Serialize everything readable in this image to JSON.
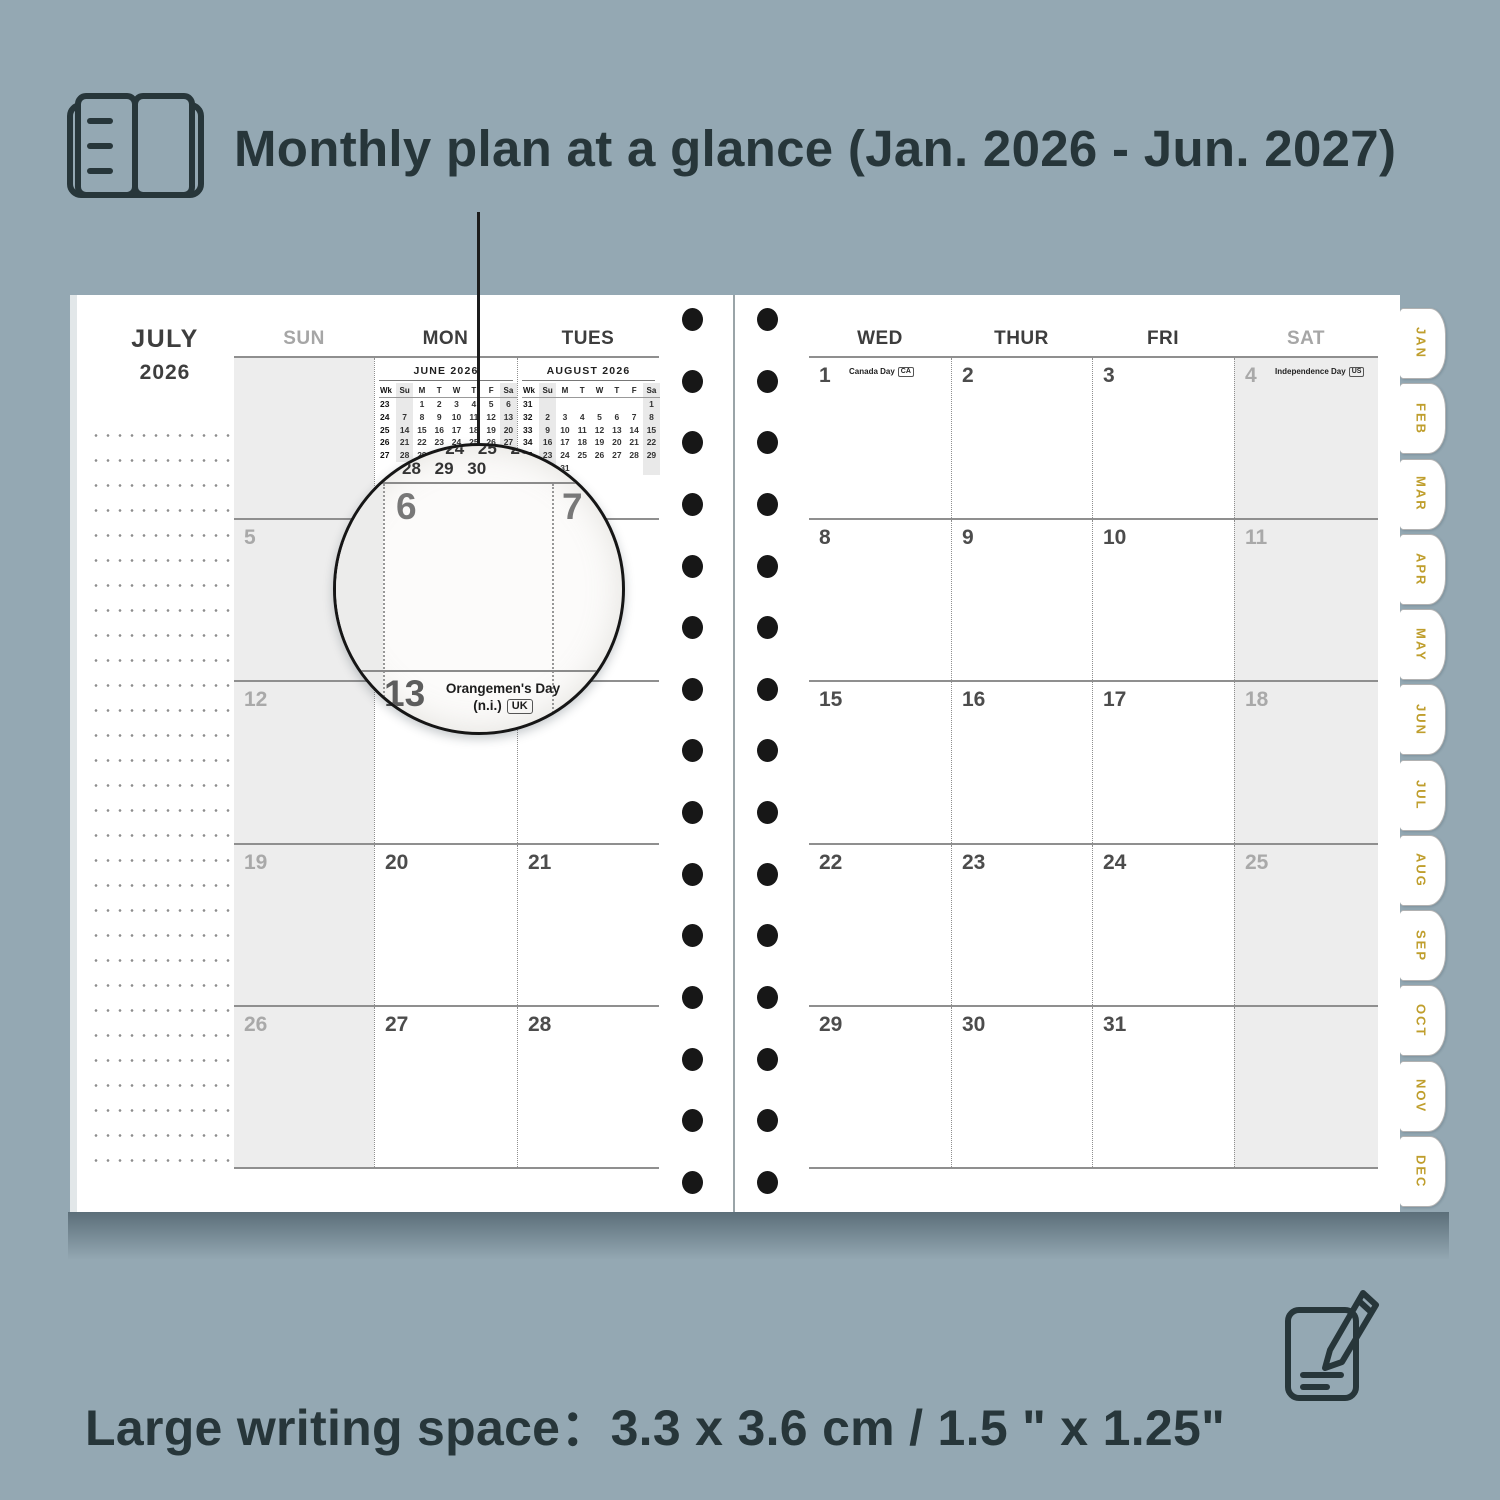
{
  "background_color": "#94a8b3",
  "accent_gold": "#bf9e2c",
  "top_caption": {
    "icon": "open-planner-icon",
    "text": "Monthly plan at a glance (Jan. 2026 - Jun. 2027)"
  },
  "bottom_caption": {
    "icon": "notepad-pencil-icon",
    "text": "Large writing space：3.3 x 3.6 cm / 1.5 \" x 1.25\""
  },
  "planner": {
    "month": "JULY",
    "year": "2026",
    "weekday_headers_left": [
      "SUN",
      "MON",
      "TUES"
    ],
    "weekday_headers_right": [
      "WED",
      "THUR",
      "FRI",
      "SAT"
    ],
    "mini_calendars": [
      {
        "title": "JUNE 2026",
        "headers": [
          "Wk",
          "Su",
          "M",
          "T",
          "W",
          "T",
          "F",
          "Sa"
        ],
        "weeks": [
          [
            "23",
            "",
            "1",
            "2",
            "3",
            "4",
            "5",
            "6"
          ],
          [
            "24",
            "7",
            "8",
            "9",
            "10",
            "11",
            "12",
            "13"
          ],
          [
            "25",
            "14",
            "15",
            "16",
            "17",
            "18",
            "19",
            "20"
          ],
          [
            "26",
            "21",
            "22",
            "23",
            "24",
            "25",
            "26",
            "27"
          ],
          [
            "27",
            "28",
            "29",
            "30",
            "",
            "",
            "",
            ""
          ]
        ]
      },
      {
        "title": "AUGUST 2026",
        "headers": [
          "Wk",
          "Su",
          "M",
          "T",
          "W",
          "T",
          "F",
          "Sa"
        ],
        "weeks": [
          [
            "31",
            "",
            "",
            "",
            "",
            "",
            "",
            "1"
          ],
          [
            "32",
            "2",
            "3",
            "4",
            "5",
            "6",
            "7",
            "8"
          ],
          [
            "33",
            "9",
            "10",
            "11",
            "12",
            "13",
            "14",
            "15"
          ],
          [
            "34",
            "16",
            "17",
            "18",
            "19",
            "20",
            "21",
            "22"
          ],
          [
            "35",
            "23",
            "24",
            "25",
            "26",
            "27",
            "28",
            "29"
          ],
          [
            "36",
            "30",
            "31",
            "",
            "",
            "",
            "",
            ""
          ]
        ]
      }
    ],
    "left_rows": [
      [
        {
          "day": "",
          "shaded": true
        },
        {
          "mini": 0
        },
        {
          "mini": 1
        }
      ],
      [
        {
          "day": "5",
          "shaded": true
        },
        {
          "day": "6"
        },
        {
          "day": "7"
        }
      ],
      [
        {
          "day": "12",
          "shaded": true
        },
        {
          "day": "13",
          "holiday": {
            "lines": [
              "Orangemen's Day",
              "(n.i.)"
            ],
            "badge": "UK"
          }
        },
        {
          "day": "14"
        }
      ],
      [
        {
          "day": "19",
          "shaded": true
        },
        {
          "day": "20"
        },
        {
          "day": "21"
        }
      ],
      [
        {
          "day": "26",
          "shaded": true
        },
        {
          "day": "27"
        },
        {
          "day": "28"
        }
      ]
    ],
    "right_rows": [
      [
        {
          "day": "1",
          "holiday": {
            "lines": [
              "Canada Day"
            ],
            "badge": "CA"
          }
        },
        {
          "day": "2"
        },
        {
          "day": "3"
        },
        {
          "day": "4",
          "shaded": true,
          "holiday": {
            "lines": [
              "Independence Day"
            ],
            "badge": "US"
          }
        }
      ],
      [
        {
          "day": "8"
        },
        {
          "day": "9"
        },
        {
          "day": "10"
        },
        {
          "day": "11",
          "shaded": true
        }
      ],
      [
        {
          "day": "15"
        },
        {
          "day": "16"
        },
        {
          "day": "17"
        },
        {
          "day": "18",
          "shaded": true
        }
      ],
      [
        {
          "day": "22"
        },
        {
          "day": "23"
        },
        {
          "day": "24"
        },
        {
          "day": "25",
          "shaded": true
        }
      ],
      [
        {
          "day": "29"
        },
        {
          "day": "30"
        },
        {
          "day": "31"
        },
        {
          "day": "",
          "shaded": true
        }
      ]
    ],
    "tabs": [
      "JAN",
      "FEB",
      "MAR",
      "APR",
      "MAY",
      "JUN",
      "JUL",
      "AUG",
      "SEP",
      "OCT",
      "NOV",
      "DEC"
    ],
    "binding_holes_per_side": 15
  },
  "magnifier": {
    "mini_row_1": "22 23 24 25 26",
    "mini_row_2": "28 29 30",
    "day_main": "6",
    "day_next": "7",
    "day_bottom": "13",
    "holiday_line1": "Orangemen's Day",
    "holiday_line2": "(n.i.)",
    "holiday_badge": "UK"
  }
}
